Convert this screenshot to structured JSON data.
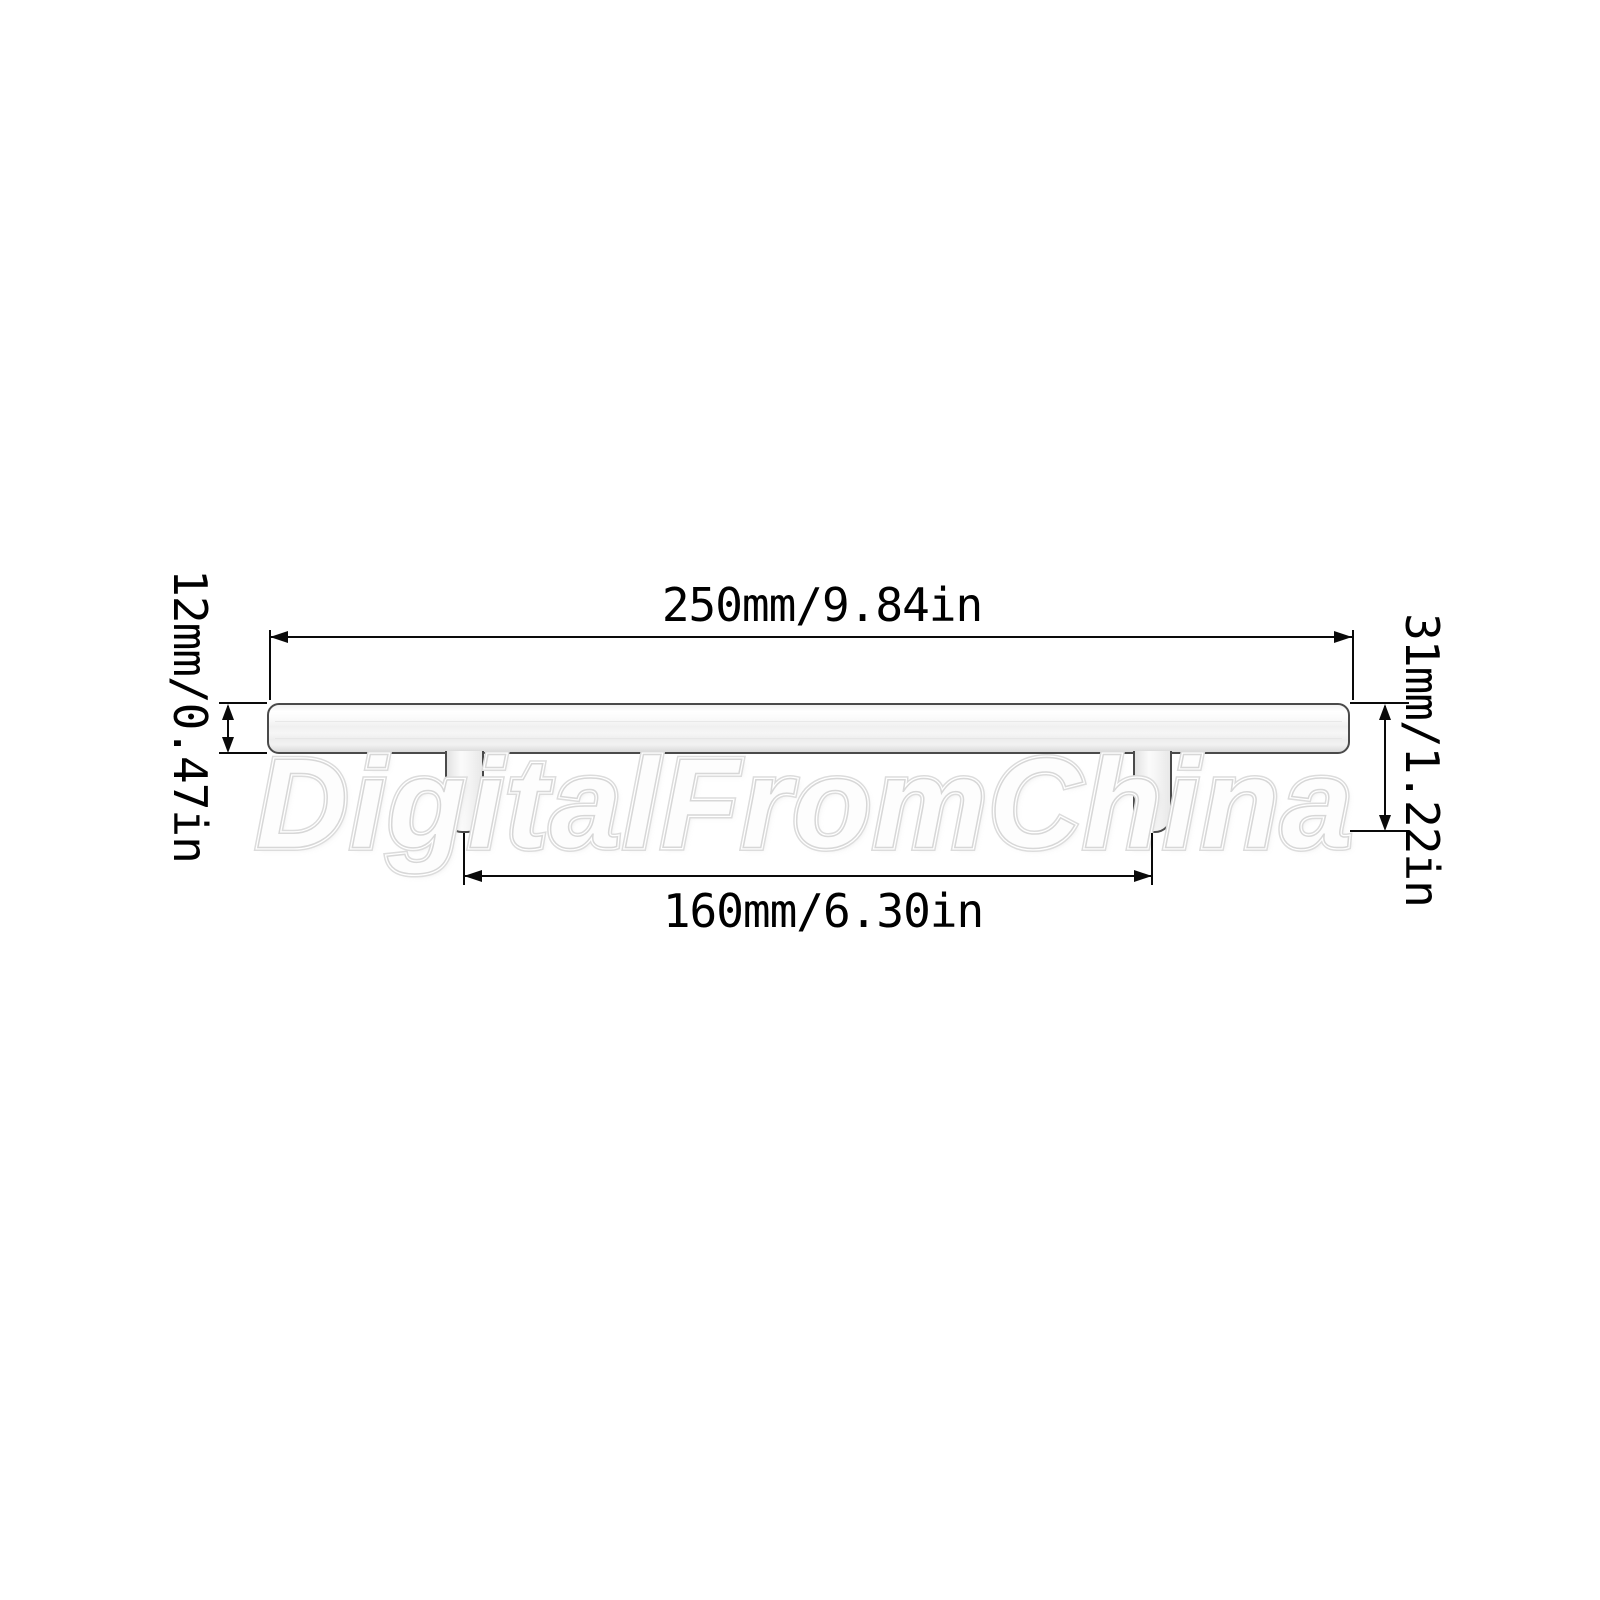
{
  "diagram": {
    "type": "technical-dimension-drawing",
    "subject": "T-bar cabinet pull handle, side view",
    "dimensions": {
      "overall_length": "250mm/9.84in",
      "hole_spacing": "160mm/6.30in",
      "bar_diameter": "12mm/0.47in",
      "overall_height": "31mm/1.22in"
    },
    "colors": {
      "background": "#ffffff",
      "dimension_line": "#0a0a0a",
      "handle_outline": "#4a4a4a",
      "handle_fill": "#f4f4f4",
      "watermark_outline": "#dcdcdc"
    }
  },
  "watermark": {
    "text": "DigitalFromChina"
  }
}
